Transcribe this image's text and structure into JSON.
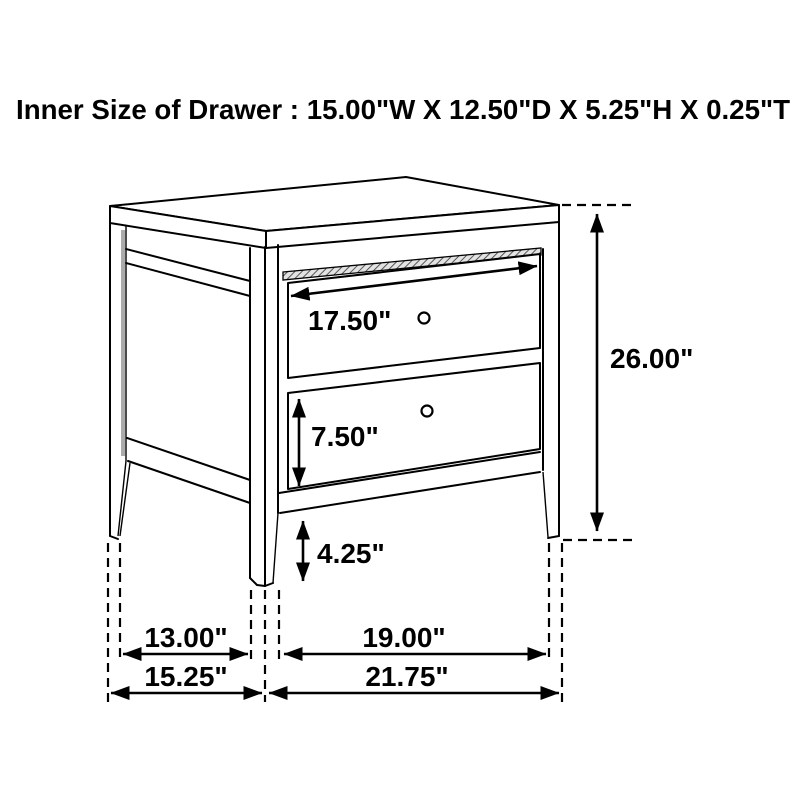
{
  "title": "Inner Size of Drawer : 15.00\"W X 12.50\"D X 5.25\"H X 0.25\"T",
  "dimensions": {
    "top_drawer_width": "17.50\"",
    "bottom_drawer_height": "7.50\"",
    "leg_height": "4.25\"",
    "overall_height": "26.00\"",
    "side_leg_spacing": "13.00\"",
    "front_leg_spacing": "19.00\"",
    "overall_depth": "15.25\"",
    "overall_width": "21.75\""
  },
  "colors": {
    "line": "#000000",
    "background": "#ffffff"
  }
}
